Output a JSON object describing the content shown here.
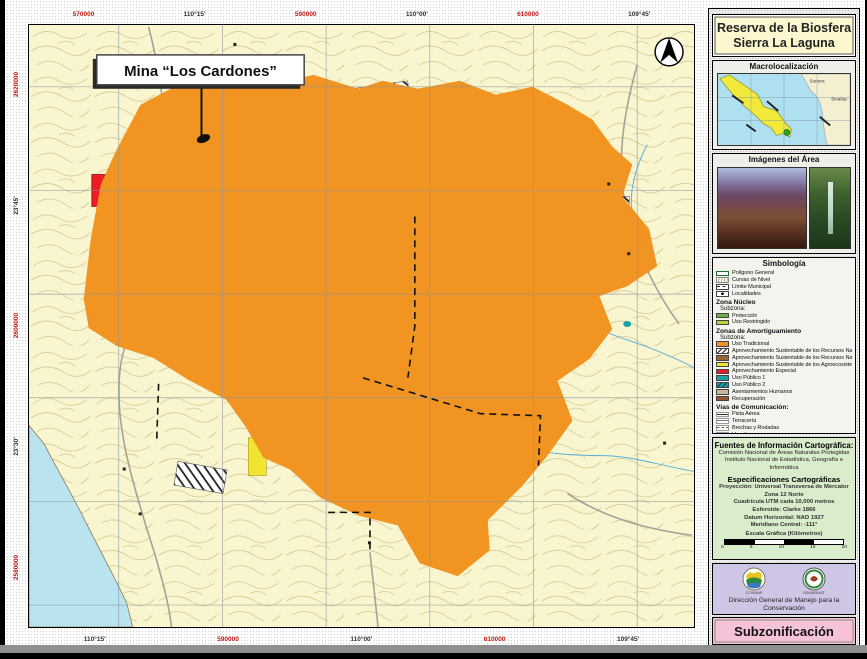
{
  "map": {
    "callout": "Mina “Los Cardones”",
    "coordinates": {
      "top": [
        {
          "text": "570000",
          "color": "#c01818"
        },
        {
          "text": "110°15'",
          "color": "#333333"
        },
        {
          "text": "590000",
          "color": "#c01818"
        },
        {
          "text": "110°00'",
          "color": "#333333"
        },
        {
          "text": "610000",
          "color": "#c01818"
        },
        {
          "text": "109°45'",
          "color": "#333333"
        }
      ],
      "bottom": [
        {
          "text": "110°15'",
          "color": "#333333"
        },
        {
          "text": "590000",
          "color": "#c01818"
        },
        {
          "text": "110°00'",
          "color": "#333333"
        },
        {
          "text": "610000",
          "color": "#c01818"
        },
        {
          "text": "109°45'",
          "color": "#333333"
        }
      ],
      "left": [
        {
          "text": "2620000",
          "color": "#c01818"
        },
        {
          "text": "23°45'",
          "color": "#333333"
        },
        {
          "text": "2600000",
          "color": "#c01818"
        },
        {
          "text": "23°30'",
          "color": "#333333"
        },
        {
          "text": "2580000",
          "color": "#c01818"
        }
      ]
    }
  },
  "sidebar": {
    "title_line1": "Reserva de la Biosfera",
    "title_line2": "Sierra La Laguna",
    "macro": {
      "title": "Macrolocalización",
      "labels": [
        "Sonora",
        "Sinaloa"
      ]
    },
    "images": {
      "title": "Imágenes del Área"
    },
    "legend": {
      "title": "Simbología",
      "sections": [
        {
          "header": null,
          "items": [
            {
              "label": "Polígono General",
              "swatch": {
                "type": "outline"
              }
            },
            {
              "label": "Curvas de Nivel",
              "swatch": {
                "type": "contours"
              }
            },
            {
              "label": "Límite Municipal",
              "swatch": {
                "type": "dashline"
              }
            },
            {
              "label": "Localidades",
              "swatch": {
                "type": "dot"
              }
            }
          ]
        },
        {
          "header": "Zona Núcleo",
          "subheader": "Subzona:",
          "items": [
            {
              "label": "Protección",
              "swatch": {
                "type": "fill",
                "color": "#67b044"
              }
            },
            {
              "label": "Uso Restringido",
              "swatch": {
                "type": "fill",
                "color": "#b9d433"
              }
            }
          ]
        },
        {
          "header": "Zonas de Amortiguamiento",
          "subheader": "Subzona:",
          "items": [
            {
              "label": "Uso Tradicional",
              "swatch": {
                "type": "fill",
                "color": "#f29422"
              }
            },
            {
              "label": "Aprovechamiento Sustentable de los Recursos Naturales 1",
              "swatch": {
                "type": "hatch-white"
              }
            },
            {
              "label": "Aprovechamiento Sustentable de los Recursos Naturales 2",
              "swatch": {
                "type": "fill",
                "color": "#996633"
              }
            },
            {
              "label": "Aprovechamiento Sustentable de los Agroecosistemas",
              "swatch": {
                "type": "fill",
                "color": "#f2e430"
              }
            },
            {
              "label": "Aprovechamiento Especial",
              "swatch": {
                "type": "fill",
                "color": "#ee1c25"
              }
            },
            {
              "label": "Uso Público 1",
              "swatch": {
                "type": "fill",
                "color": "#18a0a8"
              }
            },
            {
              "label": "Uso Público 2",
              "swatch": {
                "type": "hatch-teal"
              }
            },
            {
              "label": "Asentamientos Humanos",
              "swatch": {
                "type": "fill",
                "color": "#c9b79c"
              }
            },
            {
              "label": "Recuperación",
              "swatch": {
                "type": "fill",
                "color": "#a0522d"
              }
            }
          ]
        },
        {
          "header": "Vías de Comunicación:",
          "items": [
            {
              "label": "Pista Aérea",
              "swatch": {
                "type": "line-solid"
              }
            },
            {
              "label": "Terracería",
              "swatch": {
                "type": "line-double"
              }
            },
            {
              "label": "Brechas y Rodadas",
              "swatch": {
                "type": "line-dashed"
              }
            },
            {
              "label": "Veredas",
              "swatch": {
                "type": "line-dotted"
              }
            }
          ]
        }
      ]
    },
    "sources": {
      "title": "Fuentes de Información Cartográfica:",
      "lines": [
        "Comisión Nacional de Áreas Naturales Protegidas",
        "Instituto Nacional de Estadística, Geografía e",
        "Informática"
      ],
      "specs_title": "Especificaciones Cartográficas",
      "specs": [
        "Proyección: Universal Transversa de Mercator",
        "Zona 12 Norte",
        "Cuadrícula UTM cada 10,000 metros",
        "Esferoide: Clarke 1866",
        "Datum Horizontal: NAD 1927",
        "Meridiano Central: -111°"
      ],
      "scale_label": "Escala Gráfica (Kilómetros)",
      "scale_ticks": [
        "0",
        "5",
        "10",
        "15",
        "20"
      ]
    },
    "credits": {
      "org": "Dirección General de Manejo para la Conservación",
      "logos": [
        {
          "caption": "CONANP"
        },
        {
          "caption": "SEMARNAT"
        }
      ]
    },
    "footer": "Subzonificación"
  }
}
